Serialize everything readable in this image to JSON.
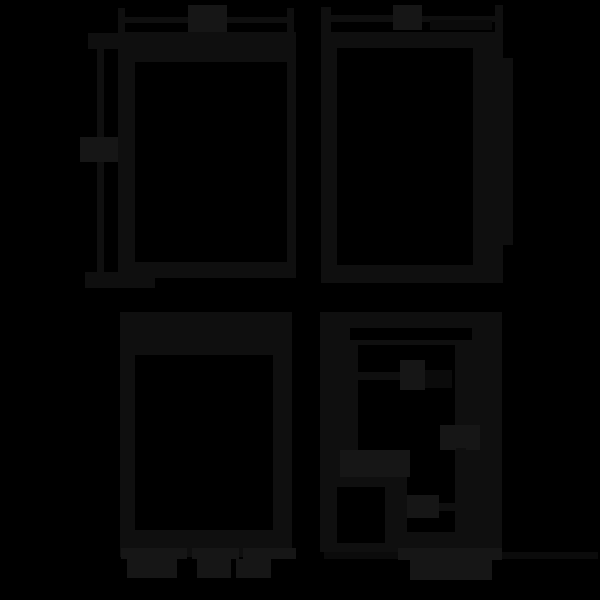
{
  "canvas": {
    "width": 600,
    "height": 600,
    "background": "#000000"
  },
  "colors": {
    "bg": "#000000",
    "ink": "#0f0f0f",
    "label": "#161616",
    "faint": "#0b0b0b"
  },
  "note": "four window-frame diagrams; all label text is illegible dark blobs on black",
  "shapes": [
    {
      "name": "panel1-width-dim-line-left",
      "color": "ink",
      "x": 120,
      "y": 17,
      "w": 68,
      "h": 6
    },
    {
      "name": "panel1-width-dim-line-right",
      "color": "ink",
      "x": 227,
      "y": 17,
      "w": 62,
      "h": 6
    },
    {
      "name": "panel1-width-dim-tick-left",
      "color": "ink",
      "x": 118,
      "y": 8,
      "w": 7,
      "h": 25
    },
    {
      "name": "panel1-width-dim-tick-right",
      "color": "ink",
      "x": 287,
      "y": 8,
      "w": 7,
      "h": 25
    },
    {
      "name": "panel1-width-dim-label-blob",
      "color": "label",
      "x": 188,
      "y": 5,
      "w": 39,
      "h": 28
    },
    {
      "name": "panel1-height-dim-line",
      "color": "ink",
      "x": 97,
      "y": 38,
      "w": 7,
      "h": 240
    },
    {
      "name": "panel1-height-dim-tick-top",
      "color": "ink",
      "x": 88,
      "y": 33,
      "w": 67,
      "h": 16
    },
    {
      "name": "panel1-height-dim-tick-bottom",
      "color": "ink",
      "x": 85,
      "y": 272,
      "w": 70,
      "h": 16
    },
    {
      "name": "panel1-height-dim-label-blob",
      "color": "label",
      "x": 80,
      "y": 137,
      "w": 42,
      "h": 25
    },
    {
      "name": "panel1-window-frame",
      "color": "ink",
      "x": 118,
      "y": 32,
      "w": 178,
      "h": 246
    },
    {
      "name": "panel1-window-opening",
      "color": "bg",
      "x": 135,
      "y": 62,
      "w": 152,
      "h": 200
    },
    {
      "name": "panel2-width-dim-line-left",
      "color": "ink",
      "x": 331,
      "y": 15,
      "w": 62,
      "h": 7
    },
    {
      "name": "panel2-width-dim-line-right",
      "color": "ink",
      "x": 422,
      "y": 16,
      "w": 73,
      "h": 6
    },
    {
      "name": "panel2-width-dim-post-left",
      "color": "ink",
      "x": 321,
      "y": 7,
      "w": 10,
      "h": 26
    },
    {
      "name": "panel2-width-dim-post-right",
      "color": "ink",
      "x": 495,
      "y": 5,
      "w": 8,
      "h": 30
    },
    {
      "name": "panel2-width-dim-label-blob",
      "color": "label",
      "x": 393,
      "y": 5,
      "w": 29,
      "h": 25
    },
    {
      "name": "panel2-width-dim-sublabel-blob",
      "color": "faint",
      "x": 430,
      "y": 20,
      "w": 62,
      "h": 10
    },
    {
      "name": "panel2-window-frame",
      "color": "ink",
      "x": 321,
      "y": 32,
      "w": 182,
      "h": 251
    },
    {
      "name": "panel2-window-opening",
      "color": "bg",
      "x": 337,
      "y": 48,
      "w": 136,
      "h": 217
    },
    {
      "name": "panel2-side-tab",
      "color": "ink",
      "x": 503,
      "y": 58,
      "w": 10,
      "h": 187
    },
    {
      "name": "panel3-window-frame",
      "color": "ink",
      "x": 120,
      "y": 312,
      "w": 172,
      "h": 245
    },
    {
      "name": "panel3-window-opening",
      "color": "bg",
      "x": 135,
      "y": 355,
      "w": 138,
      "h": 175
    },
    {
      "name": "panel3-caption-blob-1",
      "color": "label",
      "x": 121,
      "y": 548,
      "w": 66,
      "h": 11
    },
    {
      "name": "panel3-caption-blob-2",
      "color": "label",
      "x": 192,
      "y": 548,
      "w": 47,
      "h": 11
    },
    {
      "name": "panel3-caption-blob-3",
      "color": "label",
      "x": 243,
      "y": 548,
      "w": 53,
      "h": 11
    },
    {
      "name": "panel3-caption-blob-4",
      "color": "label",
      "x": 127,
      "y": 559,
      "w": 50,
      "h": 19
    },
    {
      "name": "panel3-caption-blob-5",
      "color": "label",
      "x": 197,
      "y": 559,
      "w": 34,
      "h": 19
    },
    {
      "name": "panel3-caption-blob-6",
      "color": "label",
      "x": 236,
      "y": 559,
      "w": 35,
      "h": 19
    },
    {
      "name": "panel4-window-frame",
      "color": "ink",
      "x": 320,
      "y": 312,
      "w": 182,
      "h": 240
    },
    {
      "name": "panel4-top-groove-slot",
      "color": "bg",
      "x": 350,
      "y": 328,
      "w": 122,
      "h": 12
    },
    {
      "name": "panel4-window-opening",
      "color": "bg",
      "x": 358,
      "y": 345,
      "w": 97,
      "h": 187
    },
    {
      "name": "panel4-lower-left-block",
      "color": "ink",
      "x": 330,
      "y": 477,
      "w": 77,
      "h": 75
    },
    {
      "name": "panel4-inset-square-opening",
      "color": "bg",
      "x": 337,
      "y": 487,
      "w": 48,
      "h": 56
    },
    {
      "name": "panel4-leader-a-line",
      "color": "ink",
      "x": 358,
      "y": 372,
      "w": 42,
      "h": 8
    },
    {
      "name": "panel4-annotation-a-blob",
      "color": "label",
      "x": 400,
      "y": 360,
      "w": 25,
      "h": 30
    },
    {
      "name": "panel4-annotation-a2-blob",
      "color": "faint",
      "x": 425,
      "y": 370,
      "w": 27,
      "h": 18
    },
    {
      "name": "panel4-annotation-b-blob",
      "color": "label",
      "x": 440,
      "y": 425,
      "w": 40,
      "h": 25
    },
    {
      "name": "panel4-leader-b-line",
      "color": "ink",
      "x": 456,
      "y": 448,
      "w": 10,
      "h": 92
    },
    {
      "name": "panel4-annotation-c-blob",
      "color": "label",
      "x": 340,
      "y": 450,
      "w": 70,
      "h": 27
    },
    {
      "name": "panel4-annotation-d-blob",
      "color": "label",
      "x": 407,
      "y": 495,
      "w": 32,
      "h": 23
    },
    {
      "name": "panel4-leader-d-line",
      "color": "ink",
      "x": 439,
      "y": 503,
      "w": 19,
      "h": 8
    },
    {
      "name": "panel4-baseline-line",
      "color": "faint",
      "x": 324,
      "y": 552,
      "w": 274,
      "h": 7
    },
    {
      "name": "panel4-caption-row1-blob",
      "color": "label",
      "x": 398,
      "y": 548,
      "w": 104,
      "h": 12
    },
    {
      "name": "panel4-caption-row2-blob",
      "color": "label",
      "x": 410,
      "y": 560,
      "w": 82,
      "h": 20
    }
  ]
}
